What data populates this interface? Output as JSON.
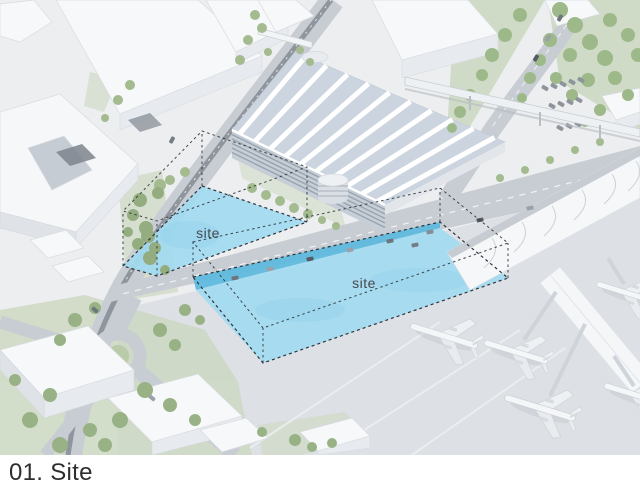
{
  "caption": {
    "label": "01. Site"
  },
  "site_annotations": {
    "left": "site",
    "right": "site"
  },
  "colors": {
    "site_highlight": "#a2daf0",
    "site_edge": "#5fb9dd",
    "dash_outline": "#2f3439",
    "caption_text": "#2e2e2e",
    "ground": "#eceef0",
    "apron": "#dde0e4",
    "road": "#c8cdd3",
    "greenery": "#a9bf97",
    "building": "#f7f8fa"
  }
}
